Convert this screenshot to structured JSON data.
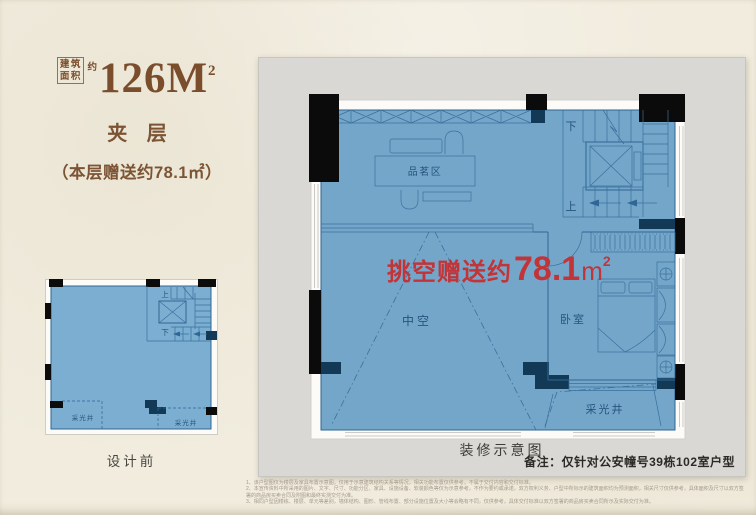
{
  "header": {
    "area_box_line1": "建筑",
    "area_box_line2": "面积",
    "area_approx": "约",
    "area_value": "126M",
    "area_sup": "2",
    "floor_title": "夹 层",
    "floor_subtitle": "（本层赠送约78.1㎡）"
  },
  "before_plan": {
    "caption": "设计前"
  },
  "after_plan": {
    "caption": "装修示意图",
    "note": "备注：仅针对公安幢号39栋102室户型",
    "overlay_prefix": "挑空赠送约",
    "overlay_value": "78.1",
    "overlay_unit": "m",
    "overlay_sup": "2"
  },
  "plan_labels": {
    "tea_area": "品茗区",
    "bedroom": "卧室",
    "void": "中空",
    "light_well": "采光井",
    "up": "上",
    "down": "下"
  },
  "disclaimer": {
    "line1": "1、该户型图仅为楼层及家具布置示意图，仅用于示意建筑结构关系等情况，相关功能布置仅供参考，不属于交付内容和交付标准。",
    "line2": "2、本宣传资料中所采用的图片、文字、尺寸、功能分区、家具、设施设备、软装颜色等仅为示意参考，不作为要约或承诺，双方权利义务、户型中所标示的建筑面积均为预测面积，相关尺寸仅供参考，具体面积及尺寸以双方签署的商品房买卖合同及附图和最终实测交付为准。",
    "line3": "3、相同户型因楼栋、楼层、单元等差别，墙体结构、图形、管线布置、部分设施位置及大小等会略有不同，仅供参考，具体交付标准以双方签署的商品房买卖合同所示及实际交付为准。"
  },
  "colors": {
    "accent_brown": "#7a4e2c",
    "plan_fill": "#74a6ca",
    "plan_line": "#2f6694",
    "wall_navy": "#123a56",
    "wall_black": "#0b0b0b",
    "highlight_red": "#c23438",
    "panel_gray": "#d9d8d5",
    "paper": "#f1ecde"
  }
}
